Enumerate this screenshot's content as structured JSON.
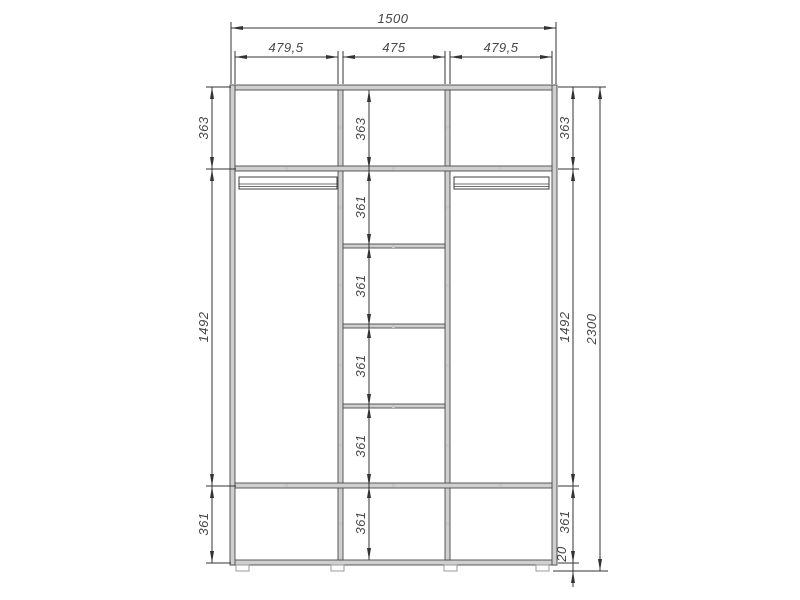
{
  "drawing": {
    "dimensions": {
      "overall_width": "1500",
      "top_sections": [
        "479,5",
        "475",
        "479,5"
      ],
      "left_column": [
        "363",
        "1492",
        "361"
      ],
      "center_column": [
        "363",
        "361",
        "361",
        "361",
        "361",
        "361"
      ],
      "right_column": [
        "363",
        "1492",
        "361"
      ],
      "plinth_height": "20",
      "overall_height": "2300"
    },
    "colors": {
      "line": "#333333",
      "panel_fill": "#cfcfcf",
      "text": "#474747",
      "background": "#ffffff"
    }
  }
}
